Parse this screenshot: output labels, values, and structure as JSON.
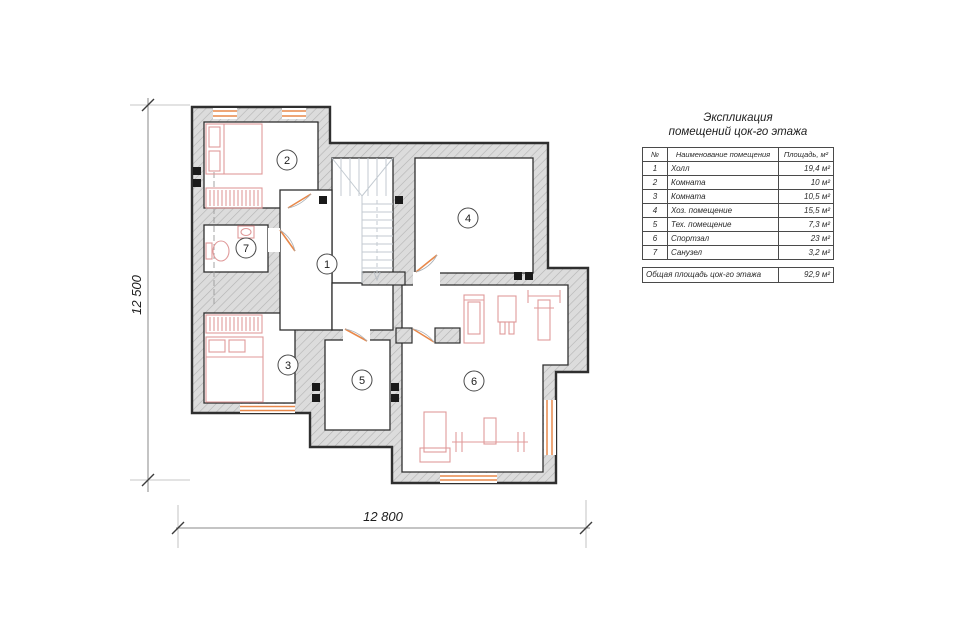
{
  "plan": {
    "dimensions": {
      "height_label": "12 500",
      "width_label": "12 800"
    },
    "rooms": [
      {
        "number": "1",
        "name": "Холл"
      },
      {
        "number": "2",
        "name": "Комната"
      },
      {
        "number": "3",
        "name": "Комната"
      },
      {
        "number": "4",
        "name": "Хоз. помещение"
      },
      {
        "number": "5",
        "name": "Тех. помещение"
      },
      {
        "number": "6",
        "name": "Спортзал"
      },
      {
        "number": "7",
        "name": "Санузел"
      }
    ]
  },
  "legend": {
    "title_line1": "Экспликация",
    "title_line2": "помещений цок-го этажа",
    "columns": {
      "num": "№",
      "name": "Наименование помещения",
      "area": "Площадь, м²"
    },
    "rows": [
      {
        "num": "1",
        "name": "Холл",
        "area": "19,4 м²"
      },
      {
        "num": "2",
        "name": "Комната",
        "area": "10 м²"
      },
      {
        "num": "3",
        "name": "Комната",
        "area": "10,5 м²"
      },
      {
        "num": "4",
        "name": "Хоз. помещение",
        "area": "15,5 м²"
      },
      {
        "num": "5",
        "name": "Тех. помещение",
        "area": "7,3 м²"
      },
      {
        "num": "6",
        "name": "Спортзал",
        "area": "23 м²"
      },
      {
        "num": "7",
        "name": "Санузел",
        "area": "3,2 м²"
      }
    ],
    "footer": {
      "label": "Общая площадь цок-го этажа",
      "area": "92,9 м²"
    }
  },
  "colors": {
    "wall_outline": "#2f2f2f",
    "wall_hatch_bg": "#dcdcdc",
    "window_door_accent": "#e8884a",
    "furniture": "#e09a9a",
    "stair_lines": "#c3cad1"
  }
}
